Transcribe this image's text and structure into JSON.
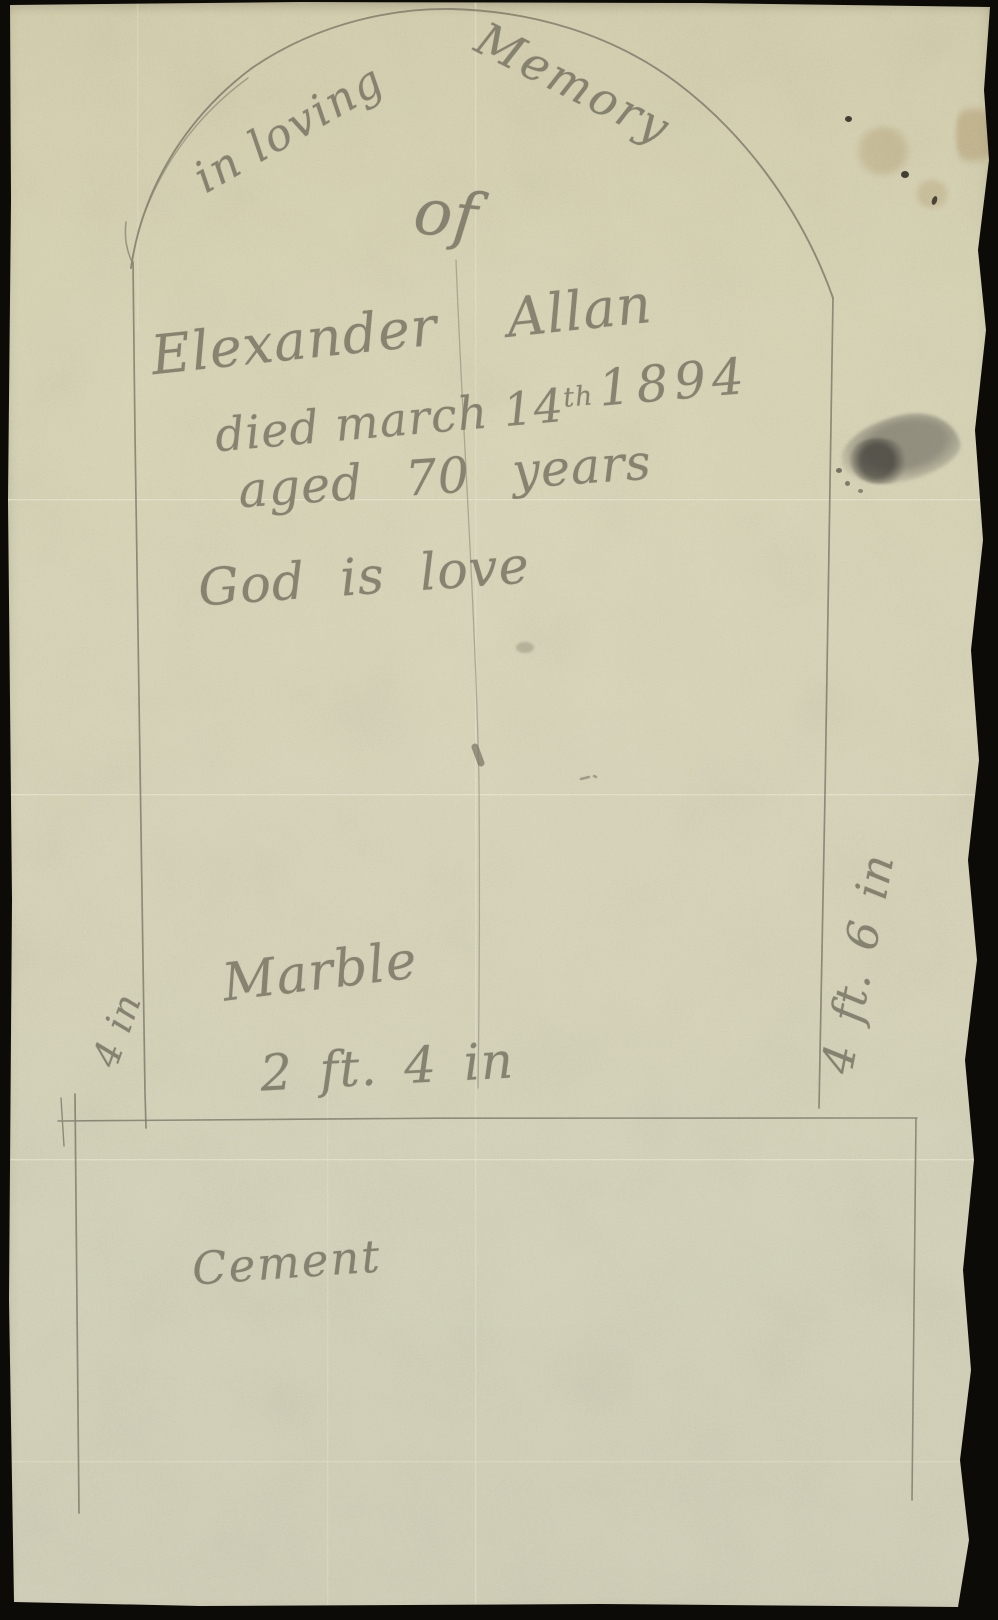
{
  "photo": {
    "background_color": "#0d0b08"
  },
  "paper": {
    "color": "#d7d3b7",
    "pencil_color": "#7f7b6a"
  },
  "inscription": {
    "memory_line_left": "in loving",
    "memory_line_right": "Memory",
    "of_word": "of",
    "name": "Elexander Allan",
    "died_line_prefix": "died march 14",
    "died_line_superscript": "th",
    "died_line_year": "1894",
    "aged_line": "aged 70 years",
    "motto": "God is love"
  },
  "annotations": {
    "stone_material": "Marble",
    "stone_width": "2 ft. 4 in",
    "base_material": "Cement",
    "left_height": "4 in",
    "right_height": "4 ft. 6 in"
  }
}
